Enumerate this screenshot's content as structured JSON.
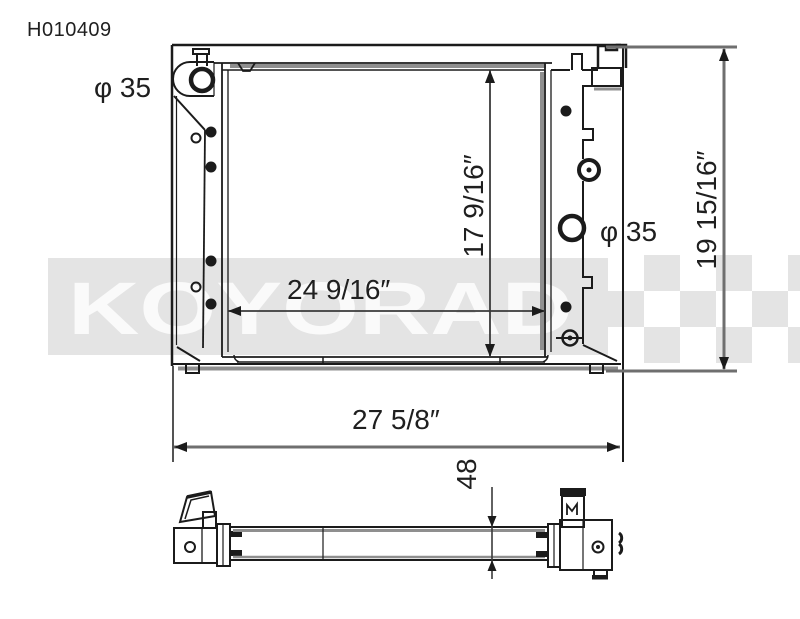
{
  "page": {
    "background": "#ffffff"
  },
  "part_number": "H010409",
  "watermark": {
    "text": "KOYORAD",
    "band_color": "#e4e4e4",
    "letter_color": "#fafafa"
  },
  "dimensions": {
    "filler_neck_diameter": "φ 35",
    "right_port_diameter": "φ 35",
    "core_width": "24 9/16″",
    "core_height": "17 9/16″",
    "overall_height": "19 15/16″",
    "overall_width": "27 5/8″",
    "core_thickness_mm": "48"
  },
  "colors": {
    "line": "#1b1b1b",
    "dimension_line": "#6f6f6f",
    "shadow_gray": "#8f8f8f",
    "watermark_gray": "#e4e4e4",
    "text": "#1f1f1f"
  }
}
